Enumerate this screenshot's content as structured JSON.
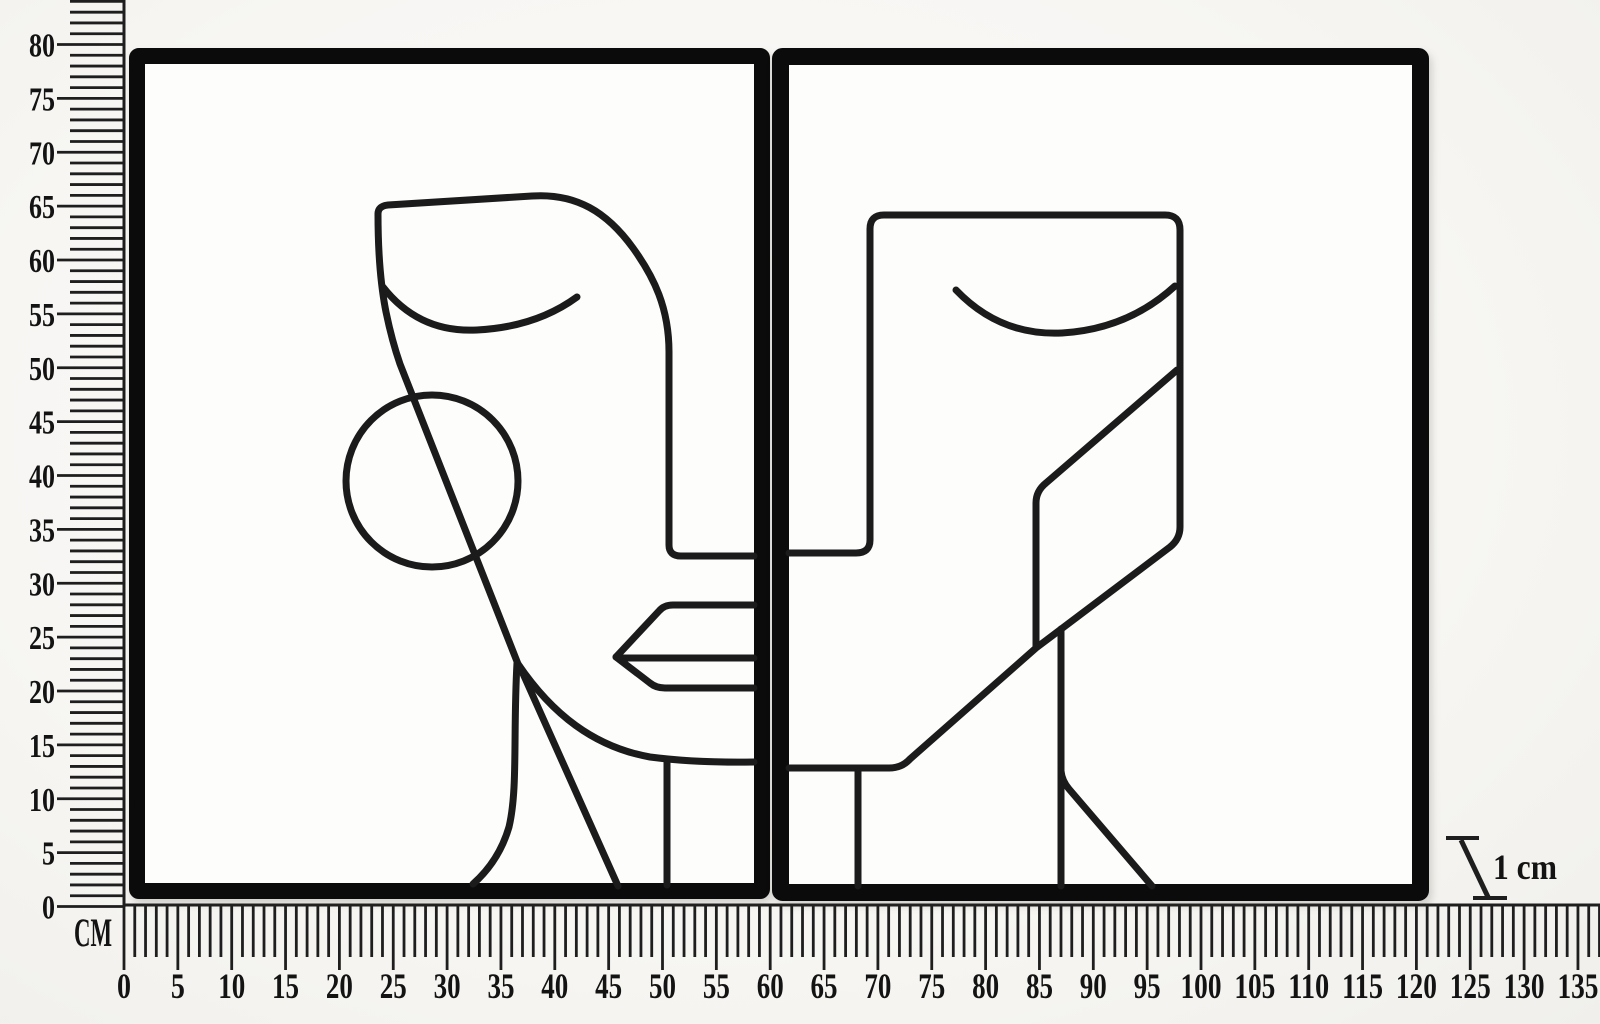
{
  "image": {
    "width_px": 1600,
    "height_px": 1024,
    "background_color": "#f7f6f3"
  },
  "artwork": {
    "type": "two-panel abstract wire line-art face wall decor",
    "panel_count": 2,
    "frame_color": "#0b0b0b",
    "wire_color": "#1b1b1b",
    "panel_fill": "#fdfdfc"
  },
  "rulers": {
    "unit_label": "CM",
    "color": "#1e1e1e",
    "vertical": {
      "min": 0,
      "max": 80,
      "tick_step_cm": 1,
      "label_step_cm": 5,
      "labels": [
        "0",
        "5",
        "10",
        "15",
        "20",
        "25",
        "30",
        "35",
        "40",
        "45",
        "50",
        "55",
        "60",
        "65",
        "70",
        "75",
        "80"
      ]
    },
    "horizontal": {
      "min": 0,
      "max": 135,
      "tick_step_cm": 1,
      "label_step_cm": 5,
      "labels": [
        "0",
        "5",
        "10",
        "15",
        "20",
        "25",
        "30",
        "35",
        "40",
        "45",
        "50",
        "55",
        "60",
        "65",
        "70",
        "75",
        "80",
        "85",
        "90",
        "95",
        "100",
        "105",
        "110",
        "115",
        "120",
        "125",
        "130",
        "135"
      ]
    }
  },
  "scale_indicator": {
    "label": "1 cm"
  }
}
